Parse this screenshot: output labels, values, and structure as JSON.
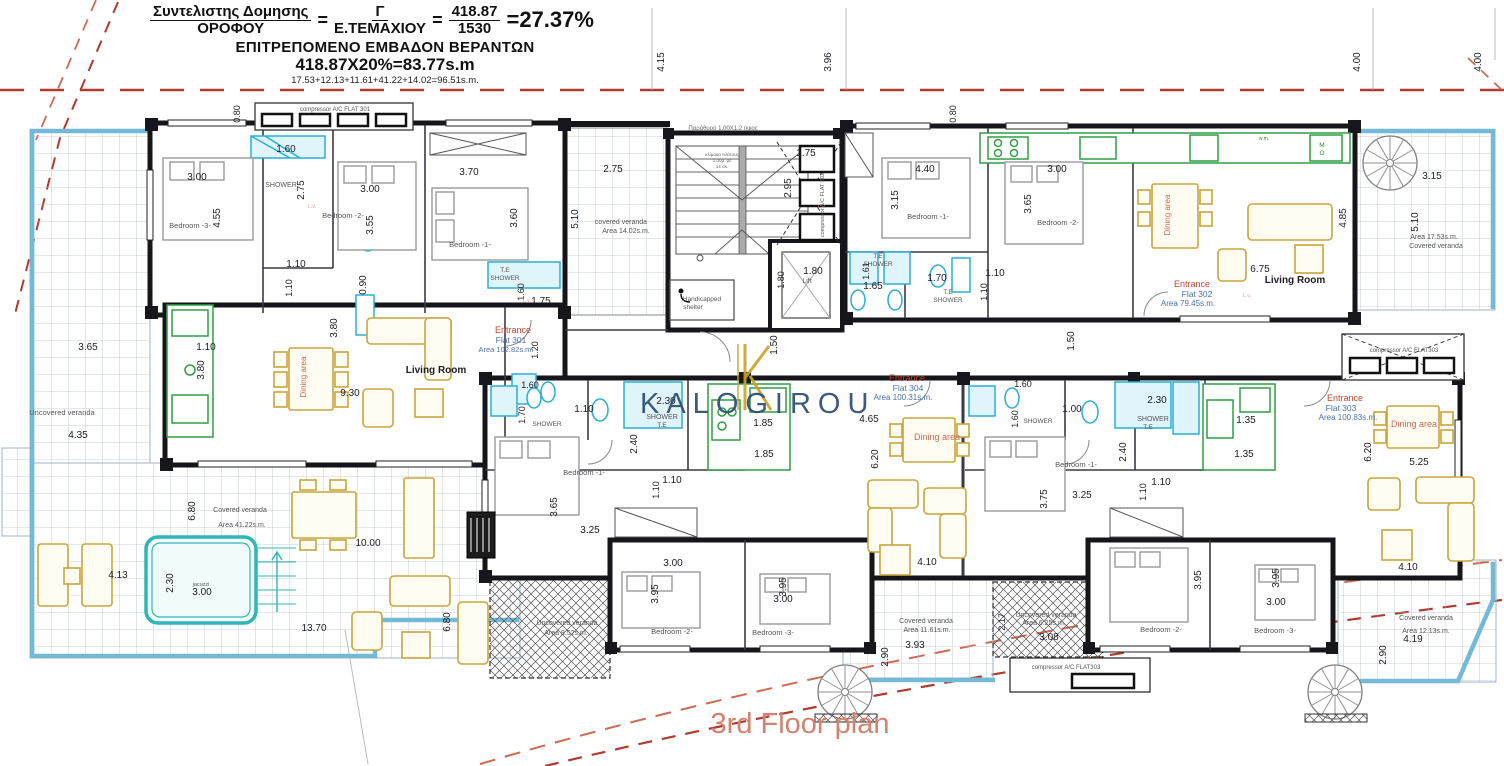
{
  "header": {
    "num1": "Συντελιστης Δομησης",
    "den1": "ΟΡΟΦΟΥ",
    "eq1": "=",
    "num2": "Γ",
    "den2": "Ε.ΤΕΜΑΧΙΟΥ",
    "eq2": "=",
    "num3": "418.87",
    "den3": "1530",
    "result": "=27.37%",
    "line2": "ΕΠΙΤΡΕΠΟΜΕΝΟ ΕΜΒΑΔΟΝ ΒΕΡΑΝΤΩΝ",
    "line3": "418.87Χ20%=83.77s.m",
    "line4": "17.53+12.13+11.61+41.22+14.02=96.51s.m."
  },
  "watermark": {
    "logo_text": "KALOGIROU"
  },
  "title": {
    "text": "3rd Floor plan"
  },
  "plan": {
    "label_colors": {
      "dim": "#1c1c24",
      "room": "#555555",
      "red": "#c0462e",
      "blue": "#4a6fa8",
      "dining": "#c96a5a",
      "green": "#2e8b3a",
      "note": "#666666",
      "lv": "#dd9999"
    },
    "labels": [
      {
        "t": "4.15",
        "x": 664,
        "y": 62,
        "r": -90
      },
      {
        "t": "3.96",
        "x": 831,
        "y": 62,
        "r": -90
      },
      {
        "t": "4.00",
        "x": 1360,
        "y": 62,
        "r": -90
      },
      {
        "t": "4.00",
        "x": 1481,
        "y": 62,
        "r": -90
      },
      {
        "t": "0.80",
        "x": 240,
        "y": 114,
        "r": -90,
        "s": 9
      },
      {
        "t": "compressor A/C FLAT 301",
        "x": 335,
        "y": 111,
        "s": 6,
        "c": "room",
        "n": "ac-compressor-label"
      },
      {
        "t": "1.60",
        "x": 286,
        "y": 152
      },
      {
        "t": "3.00",
        "x": 197,
        "y": 180
      },
      {
        "t": "2.75",
        "x": 304,
        "y": 190,
        "r": -90
      },
      {
        "t": "SHOWER",
        "x": 281,
        "y": 187,
        "s": 7,
        "c": "room"
      },
      {
        "t": "Bedroom -3-",
        "x": 190,
        "y": 228,
        "s": 7.5,
        "c": "room"
      },
      {
        "t": "4.55",
        "x": 220,
        "y": 218,
        "r": -90
      },
      {
        "t": "3.00",
        "x": 370,
        "y": 192
      },
      {
        "t": "Bedroom -2-",
        "x": 343,
        "y": 218,
        "s": 7.5,
        "c": "room"
      },
      {
        "t": "3.55",
        "x": 373,
        "y": 225,
        "r": -90
      },
      {
        "t": "3.70",
        "x": 469,
        "y": 175
      },
      {
        "t": "Bedroom -1-",
        "x": 470,
        "y": 247,
        "s": 7.5,
        "c": "room"
      },
      {
        "t": "3.60",
        "x": 517,
        "y": 218,
        "r": -90
      },
      {
        "t": "1.10",
        "x": 296,
        "y": 267
      },
      {
        "t": "1.10",
        "x": 292,
        "y": 288,
        "r": -90,
        "s": 9
      },
      {
        "t": "0.90",
        "x": 366,
        "y": 285,
        "r": -90
      },
      {
        "t": "T.E",
        "x": 505,
        "y": 272,
        "s": 6.5,
        "c": "room"
      },
      {
        "t": "SHOWER",
        "x": 505,
        "y": 280,
        "s": 6.5,
        "c": "room"
      },
      {
        "t": "1.60",
        "x": 524,
        "y": 292,
        "r": -90,
        "s": 9
      },
      {
        "t": "1.75",
        "x": 541,
        "y": 304
      },
      {
        "t": "L.v.",
        "x": 312,
        "y": 208,
        "s": 5,
        "c": "lv"
      },
      {
        "t": "L.v.",
        "x": 822,
        "y": 208,
        "s": 5,
        "c": "lv"
      },
      {
        "t": "L.v.",
        "x": 527,
        "y": 302,
        "s": 5,
        "c": "lv"
      },
      {
        "t": "L.v.",
        "x": 1247,
        "y": 297,
        "s": 5,
        "c": "lv"
      },
      {
        "t": "2.75",
        "x": 613,
        "y": 172
      },
      {
        "t": "5.10",
        "x": 578,
        "y": 219,
        "r": -90
      },
      {
        "t": "covered veranda",
        "x": 621,
        "y": 224,
        "s": 7,
        "c": "room"
      },
      {
        "t": "Area 14.02s.m.",
        "x": 626,
        "y": 233,
        "s": 7,
        "c": "room"
      },
      {
        "t": "Παράθυρο 1.00Χ1.2 ύψος",
        "x": 723,
        "y": 130,
        "s": 6,
        "c": "note"
      },
      {
        "t": "κλίμακα πλάτους",
        "x": 722,
        "y": 156,
        "s": 4.5,
        "c": "note",
        "n": "stair-note"
      },
      {
        "t": "1.00μ. με",
        "x": 722,
        "y": 162,
        "s": 4.5,
        "c": "note",
        "n": "stair-note"
      },
      {
        "t": "14 σκ.",
        "x": 722,
        "y": 168,
        "s": 4.5,
        "c": "note",
        "n": "stair-note"
      },
      {
        "t": "1.75",
        "x": 806,
        "y": 156
      },
      {
        "t": "2.95",
        "x": 791,
        "y": 188,
        "r": -90
      },
      {
        "t": "compressor A/C FLAT 302",
        "x": 824,
        "y": 205,
        "r": -90,
        "s": 5.5,
        "c": "room",
        "n": "ac-compressor-label"
      },
      {
        "t": "1.80",
        "x": 784,
        "y": 280,
        "r": -90,
        "s": 9
      },
      {
        "t": "1.80",
        "x": 813,
        "y": 274
      },
      {
        "t": "Lift",
        "x": 807,
        "y": 283,
        "s": 7,
        "c": "room",
        "n": "lift-label"
      },
      {
        "t": "Handicapped",
        "x": 702,
        "y": 301,
        "s": 6.5,
        "c": "room",
        "n": "handicapped-shelter-label"
      },
      {
        "t": "shelter",
        "x": 693,
        "y": 309,
        "s": 6.5,
        "c": "room",
        "n": "handicapped-shelter-label"
      },
      {
        "t": "1.50",
        "x": 777,
        "y": 345,
        "r": -90
      },
      {
        "t": "1.50",
        "x": 1074,
        "y": 341,
        "r": -90
      },
      {
        "t": "0.80",
        "x": 956,
        "y": 114,
        "r": -90,
        "s": 9
      },
      {
        "t": "4.40",
        "x": 925,
        "y": 172
      },
      {
        "t": "3.15",
        "x": 898,
        "y": 200,
        "r": -90
      },
      {
        "t": "Bedroom -1-",
        "x": 928,
        "y": 219,
        "s": 7.5,
        "c": "room"
      },
      {
        "t": "3.00",
        "x": 1057,
        "y": 172
      },
      {
        "t": "3.65",
        "x": 1031,
        "y": 204,
        "r": -90
      },
      {
        "t": "Bedroom -2-",
        "x": 1058,
        "y": 225,
        "s": 7.5,
        "c": "room"
      },
      {
        "t": "T.E",
        "x": 878,
        "y": 258,
        "s": 6.5,
        "c": "room"
      },
      {
        "t": "SHOWER",
        "x": 878,
        "y": 266,
        "s": 6.5,
        "c": "room"
      },
      {
        "t": "1.61",
        "x": 869,
        "y": 271,
        "r": -90,
        "s": 9
      },
      {
        "t": "1.65",
        "x": 873,
        "y": 289
      },
      {
        "t": "1.70",
        "x": 937,
        "y": 281
      },
      {
        "t": "T.E",
        "x": 948,
        "y": 294,
        "s": 6.5,
        "c": "room"
      },
      {
        "t": "SHOWER",
        "x": 948,
        "y": 302,
        "s": 6.5,
        "c": "room"
      },
      {
        "t": "1.10",
        "x": 995,
        "y": 276
      },
      {
        "t": "1.10",
        "x": 987,
        "y": 292,
        "r": -90,
        "s": 9
      },
      {
        "t": "Dining area",
        "x": 1170,
        "y": 215,
        "r": -90,
        "s": 8,
        "c": "dining"
      },
      {
        "t": "w.m.",
        "x": 1264,
        "y": 140,
        "s": 5,
        "c": "green"
      },
      {
        "t": "M",
        "x": 1322,
        "y": 147,
        "s": 6.5,
        "c": "green"
      },
      {
        "t": "O",
        "x": 1322,
        "y": 155,
        "s": 6.5,
        "c": "green"
      },
      {
        "t": "4.85",
        "x": 1346,
        "y": 218,
        "r": -90
      },
      {
        "t": "6.75",
        "x": 1260,
        "y": 272
      },
      {
        "t": "Living Room",
        "x": 1295,
        "y": 283,
        "s": 10,
        "b": 1
      },
      {
        "t": "Entrance",
        "x": 1192,
        "y": 287,
        "s": 9,
        "c": "red",
        "n": "flat-302-entrance-label"
      },
      {
        "t": "Flat 302",
        "x": 1197,
        "y": 297,
        "s": 8.5,
        "c": "blue",
        "n": "flat-302-label"
      },
      {
        "t": "Area 79.45s.m.",
        "x": 1188,
        "y": 306,
        "s": 8,
        "c": "blue",
        "n": "flat-302-area-label"
      },
      {
        "t": "3.15",
        "x": 1432,
        "y": 179
      },
      {
        "t": "5.10",
        "x": 1418,
        "y": 222,
        "r": -90
      },
      {
        "t": "Area 17.53s.m.",
        "x": 1434,
        "y": 239,
        "s": 7,
        "c": "room"
      },
      {
        "t": "Covered veranda",
        "x": 1436,
        "y": 248,
        "s": 7,
        "c": "room"
      },
      {
        "t": "1.10",
        "x": 206,
        "y": 350
      },
      {
        "t": "3.80",
        "x": 204,
        "y": 370,
        "r": -90
      },
      {
        "t": "Dining area",
        "x": 306,
        "y": 377,
        "r": -90,
        "s": 8,
        "c": "dining"
      },
      {
        "t": "3.80",
        "x": 337,
        "y": 328,
        "r": -90
      },
      {
        "t": "9.30",
        "x": 350,
        "y": 396
      },
      {
        "t": "Living Room",
        "x": 436,
        "y": 373,
        "s": 10,
        "b": 1
      },
      {
        "t": "Entrance",
        "x": 513,
        "y": 333,
        "s": 9,
        "c": "red",
        "n": "flat-301-entrance-label"
      },
      {
        "t": "Flat 301",
        "x": 511,
        "y": 343,
        "s": 8.5,
        "c": "blue",
        "n": "flat-301-label"
      },
      {
        "t": "Area 102.82s.m.",
        "x": 506,
        "y": 352,
        "s": 7.5,
        "c": "blue",
        "n": "flat-301-area-label"
      },
      {
        "t": "1.20",
        "x": 538,
        "y": 350,
        "r": -90,
        "s": 9
      },
      {
        "t": "1.60",
        "x": 530,
        "y": 388,
        "s": 9
      },
      {
        "t": "1.70",
        "x": 525,
        "y": 415,
        "r": -90,
        "s": 9
      },
      {
        "t": "SHOWER",
        "x": 547,
        "y": 426,
        "s": 6.5,
        "c": "room"
      },
      {
        "t": "3.65",
        "x": 88,
        "y": 350
      },
      {
        "t": "Uncovered veranda",
        "x": 62,
        "y": 415,
        "s": 7.5,
        "c": "room"
      },
      {
        "t": "4.35",
        "x": 78,
        "y": 438
      },
      {
        "t": "6.80",
        "x": 195,
        "y": 511,
        "r": -90
      },
      {
        "t": "Covered veranda",
        "x": 240,
        "y": 512,
        "s": 7,
        "c": "room"
      },
      {
        "t": "Area 41.22s.m.",
        "x": 242,
        "y": 527,
        "s": 7,
        "c": "room"
      },
      {
        "t": "4.13",
        "x": 118,
        "y": 578
      },
      {
        "t": "2.30",
        "x": 173,
        "y": 583,
        "r": -90
      },
      {
        "t": "jacuzzi",
        "x": 201,
        "y": 586,
        "s": 5.5,
        "c": "room",
        "n": "jacuzzi-label"
      },
      {
        "t": "3.00",
        "x": 202,
        "y": 595
      },
      {
        "t": "13.70",
        "x": 314,
        "y": 631
      },
      {
        "t": "10.00",
        "x": 368,
        "y": 546
      },
      {
        "t": "6.80",
        "x": 450,
        "y": 622,
        "r": -90
      },
      {
        "t": "Entrance",
        "x": 907,
        "y": 381,
        "s": 9,
        "c": "red",
        "n": "flat-304-entrance-label"
      },
      {
        "t": "Flat 304",
        "x": 908,
        "y": 391,
        "s": 8.5,
        "c": "blue",
        "n": "flat-304-label"
      },
      {
        "t": "Area 100.31s.m.",
        "x": 903,
        "y": 400,
        "s": 8,
        "c": "blue",
        "n": "flat-304-area-label"
      },
      {
        "t": "4.65",
        "x": 869,
        "y": 422
      },
      {
        "t": "6.20",
        "x": 878,
        "y": 459,
        "r": -90
      },
      {
        "t": "Dining area",
        "x": 937,
        "y": 440,
        "s": 9,
        "c": "dining"
      },
      {
        "t": "4.10",
        "x": 927,
        "y": 565
      },
      {
        "t": "1.85",
        "x": 763,
        "y": 426
      },
      {
        "t": "1.85",
        "x": 764,
        "y": 457
      },
      {
        "t": "1.10",
        "x": 584,
        "y": 412
      },
      {
        "t": "2.30",
        "x": 666,
        "y": 404
      },
      {
        "t": "SHOWER",
        "x": 662,
        "y": 419,
        "s": 7,
        "c": "room"
      },
      {
        "t": "T.E",
        "x": 662,
        "y": 427,
        "s": 6.5,
        "c": "room"
      },
      {
        "t": "2.40",
        "x": 637,
        "y": 444,
        "r": -90
      },
      {
        "t": "Bedroom -1-",
        "x": 584,
        "y": 475,
        "s": 7.5,
        "c": "room"
      },
      {
        "t": "3.65",
        "x": 557,
        "y": 507,
        "r": -90
      },
      {
        "t": "3.25",
        "x": 590,
        "y": 533
      },
      {
        "t": "1.10",
        "x": 672,
        "y": 483
      },
      {
        "t": "1.10",
        "x": 659,
        "y": 490,
        "r": -90,
        "s": 9
      },
      {
        "t": "3.00",
        "x": 673,
        "y": 566
      },
      {
        "t": "3.95",
        "x": 658,
        "y": 594,
        "r": -90
      },
      {
        "t": "Bedroom -2-",
        "x": 672,
        "y": 634,
        "s": 7.5,
        "c": "room"
      },
      {
        "t": "3.95",
        "x": 786,
        "y": 587,
        "r": -90
      },
      {
        "t": "3.00",
        "x": 783,
        "y": 602
      },
      {
        "t": "Bedroom -3-",
        "x": 773,
        "y": 635,
        "s": 7.5,
        "c": "room"
      },
      {
        "t": "Uncovered veranda",
        "x": 567,
        "y": 625,
        "s": 7,
        "c": "room"
      },
      {
        "t": "Area 8.52s.m.",
        "x": 566,
        "y": 635,
        "s": 7,
        "c": "room"
      },
      {
        "t": "Covered veranda",
        "x": 926,
        "y": 623,
        "s": 7,
        "c": "room"
      },
      {
        "t": "Area 11.61s.m.",
        "x": 927,
        "y": 632,
        "s": 7,
        "c": "room"
      },
      {
        "t": "3.93",
        "x": 915,
        "y": 648
      },
      {
        "t": "2.90",
        "x": 888,
        "y": 657,
        "r": -90
      },
      {
        "t": "Uncovered veranda",
        "x": 1046,
        "y": 617,
        "s": 7,
        "c": "room"
      },
      {
        "t": "Area 6.25s.m.",
        "x": 1044,
        "y": 625,
        "s": 7,
        "c": "room"
      },
      {
        "t": "3.08",
        "x": 1049,
        "y": 640
      },
      {
        "t": "2.17",
        "x": 1005,
        "y": 622,
        "r": -90,
        "s": 9
      },
      {
        "t": "compressor A/C FLAT303",
        "x": 1066,
        "y": 669,
        "s": 6,
        "c": "room",
        "n": "ac-compressor-label"
      },
      {
        "t": "Entrance",
        "x": 1345,
        "y": 401,
        "s": 9,
        "c": "red",
        "n": "flat-303-entrance-label"
      },
      {
        "t": "Flat 303",
        "x": 1341,
        "y": 411,
        "s": 8.5,
        "c": "blue",
        "n": "flat-303-label"
      },
      {
        "t": "Area 100.83s.m.",
        "x": 1348,
        "y": 420,
        "s": 8,
        "c": "blue",
        "n": "flat-303-area-label"
      },
      {
        "t": "Dining area",
        "x": 1414,
        "y": 427,
        "s": 9,
        "c": "dining"
      },
      {
        "t": "6.20",
        "x": 1371,
        "y": 452,
        "r": -90
      },
      {
        "t": "5.25",
        "x": 1419,
        "y": 465
      },
      {
        "t": "4.10",
        "x": 1408,
        "y": 570
      },
      {
        "t": "1.35",
        "x": 1246,
        "y": 423
      },
      {
        "t": "1.35",
        "x": 1244,
        "y": 457
      },
      {
        "t": "1.60",
        "x": 1023,
        "y": 387,
        "s": 9
      },
      {
        "t": "1.60",
        "x": 1018,
        "y": 419,
        "r": -90,
        "s": 9
      },
      {
        "t": "SHOWER",
        "x": 1038,
        "y": 423,
        "s": 6.5,
        "c": "room"
      },
      {
        "t": "1.00",
        "x": 1072,
        "y": 412
      },
      {
        "t": "2.30",
        "x": 1157,
        "y": 403
      },
      {
        "t": "SHOWER",
        "x": 1153,
        "y": 421,
        "s": 7,
        "c": "room"
      },
      {
        "t": "T.E",
        "x": 1148,
        "y": 429,
        "s": 6.5,
        "c": "room"
      },
      {
        "t": "2.40",
        "x": 1126,
        "y": 452,
        "r": -90
      },
      {
        "t": "Bedroom -1-",
        "x": 1076,
        "y": 467,
        "s": 7.5,
        "c": "room"
      },
      {
        "t": "3.75",
        "x": 1047,
        "y": 499,
        "r": -90
      },
      {
        "t": "3.25",
        "x": 1082,
        "y": 498
      },
      {
        "t": "1.10",
        "x": 1161,
        "y": 485
      },
      {
        "t": "1.10",
        "x": 1146,
        "y": 492,
        "r": -90,
        "s": 9
      },
      {
        "t": "3.95",
        "x": 1201,
        "y": 580,
        "r": -90
      },
      {
        "t": "Bedroom -2-",
        "x": 1161,
        "y": 632,
        "s": 7.5,
        "c": "room"
      },
      {
        "t": "3.95",
        "x": 1279,
        "y": 578,
        "r": -90
      },
      {
        "t": "3.00",
        "x": 1276,
        "y": 605
      },
      {
        "t": "Bedroom -3-",
        "x": 1275,
        "y": 633,
        "s": 7.5,
        "c": "room"
      },
      {
        "t": "Covered veranda",
        "x": 1426,
        "y": 620,
        "s": 7,
        "c": "room"
      },
      {
        "t": "Area 12.13s.m.",
        "x": 1426,
        "y": 633,
        "s": 7,
        "c": "room"
      },
      {
        "t": "4.19",
        "x": 1413,
        "y": 642
      },
      {
        "t": "2.90",
        "x": 1386,
        "y": 655,
        "r": -90
      },
      {
        "t": "compressor A/C FLAT303",
        "x": 1404,
        "y": 352,
        "s": 6,
        "c": "room",
        "n": "ac-compressor-label"
      }
    ]
  }
}
